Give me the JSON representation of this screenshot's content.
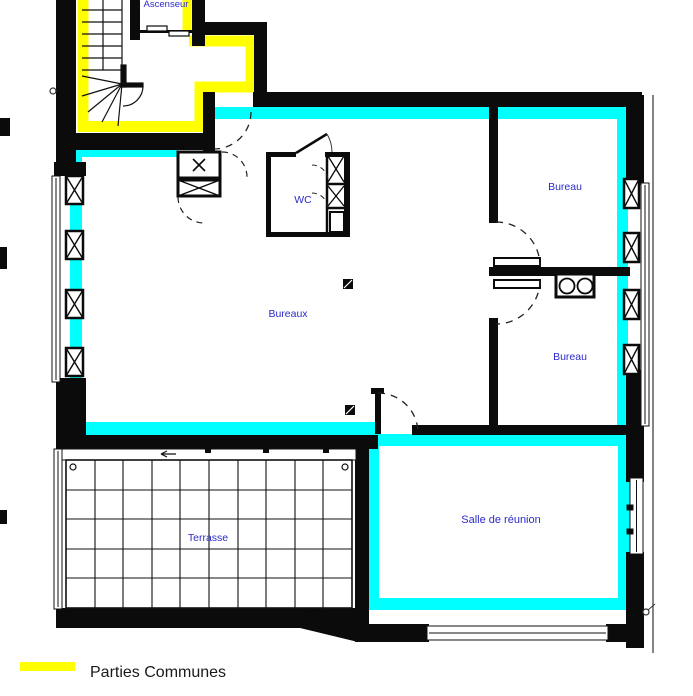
{
  "plan": {
    "labels": {
      "ascenseur": "Ascenseur",
      "wc": "WC",
      "bureau_top": "Bureau",
      "bureaux": "Bureaux",
      "bureau_bottom": "Bureau",
      "salle_reunion": "Salle de réunion",
      "terrasse": "Terrasse"
    },
    "colors": {
      "common_areas": "#FFFF00",
      "office_highlight": "#00FFFF",
      "walls": "#0B0B0B",
      "room_label": "#2B2BC8"
    }
  },
  "legend": {
    "items": [
      {
        "label": "Parties Communes",
        "swatch_color": "#FFFF00"
      }
    ]
  }
}
